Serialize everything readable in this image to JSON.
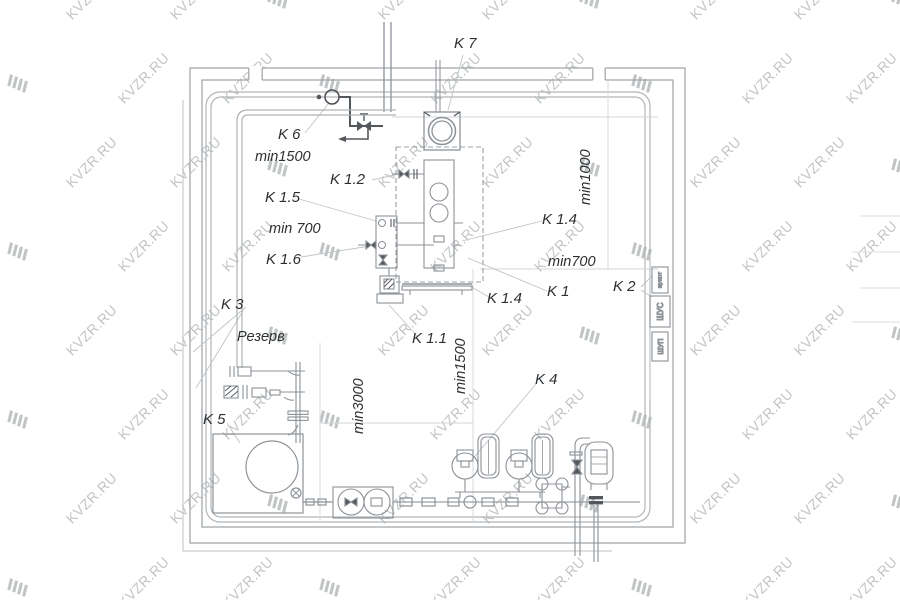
{
  "watermark": {
    "text": "KVZR.RU",
    "color": "#b7babc"
  },
  "labels": {
    "k7": "K 7",
    "k6": "K 6",
    "min1500_top": "min1500",
    "k12": "K 1.2",
    "k15": "K 1.5",
    "min700_left": "min 700",
    "k16": "K 1.6",
    "min1000": "min1000",
    "k14_upper": "K 1.4",
    "min700_right": "min700",
    "k1": "K 1",
    "k2": "K 2",
    "k14_lower": "K 1.4",
    "k3": "K 3",
    "reserve": "Резерв",
    "k11": "K 1.1",
    "min1500_mid": "min1500",
    "k4": "K 4",
    "min3000": "min3000",
    "k5": "K 5"
  },
  "cabinets": {
    "top": "ЩУКОТ",
    "middle": "ШУС",
    "bottom": "ШУП"
  },
  "colors": {
    "wall": "#a4a9ad",
    "equipment": "#8d9297",
    "dark": "#54585c",
    "guide": "#d3d6d9",
    "leader": "#c0c4c7",
    "label": "#2d3033"
  }
}
